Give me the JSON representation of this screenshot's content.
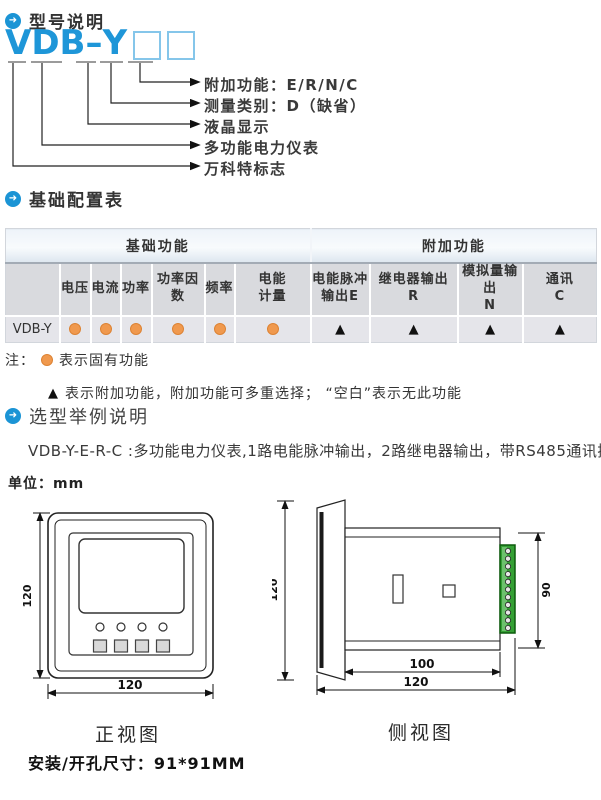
{
  "icons": {
    "section_bullet": "➜"
  },
  "symbols": {
    "triangle": "▲"
  },
  "headings": {
    "model": "型号说明",
    "config": "基础配置表",
    "example": "选型举例说明"
  },
  "model_diagram": {
    "model": "VDB–Y",
    "labels": [
      "附加功能：E/R/N/C",
      "测量类别：D（缺省）",
      "液晶显示",
      "多功能电力仪表",
      "万科特标志"
    ]
  },
  "config_table": {
    "group_headers": [
      "基础功能",
      "附加功能"
    ],
    "columns": [
      {
        "l1": "电压",
        "l2": ""
      },
      {
        "l1": "电流",
        "l2": ""
      },
      {
        "l1": "功率",
        "l2": ""
      },
      {
        "l1": "功率因数",
        "l2": ""
      },
      {
        "l1": "频率",
        "l2": ""
      },
      {
        "l1": "电能",
        "l2": "计量"
      },
      {
        "l1": "电能脉冲",
        "l2": "输出E"
      },
      {
        "l1": "继电器输出",
        "l2": "R"
      },
      {
        "l1": "模拟量输出",
        "l2": "N"
      },
      {
        "l1": "通讯",
        "l2": "C"
      }
    ],
    "row_label": "VDB-Y"
  },
  "notes": {
    "prefix": "注：",
    "fixed_legend": "表示固有功能",
    "optional_legend": "表示附加功能，附加功能可多重选择； “空白”表示无此功能"
  },
  "example_line": "VDB-Y-E-R-C :多功能电力仪表,1路电能脉冲输出，2路继电器输出，带RS485通讯接口",
  "drawings": {
    "unit_label": "单位：mm",
    "front": {
      "caption": "正视图",
      "height_dim": "120",
      "width_dim": "120"
    },
    "side": {
      "caption": "侧视图",
      "height_dim": "120",
      "terminal_dim": "90",
      "body_dim": "100",
      "total_dim": "120"
    }
  },
  "install_note": "安装/开孔尺寸：91*91MM"
}
